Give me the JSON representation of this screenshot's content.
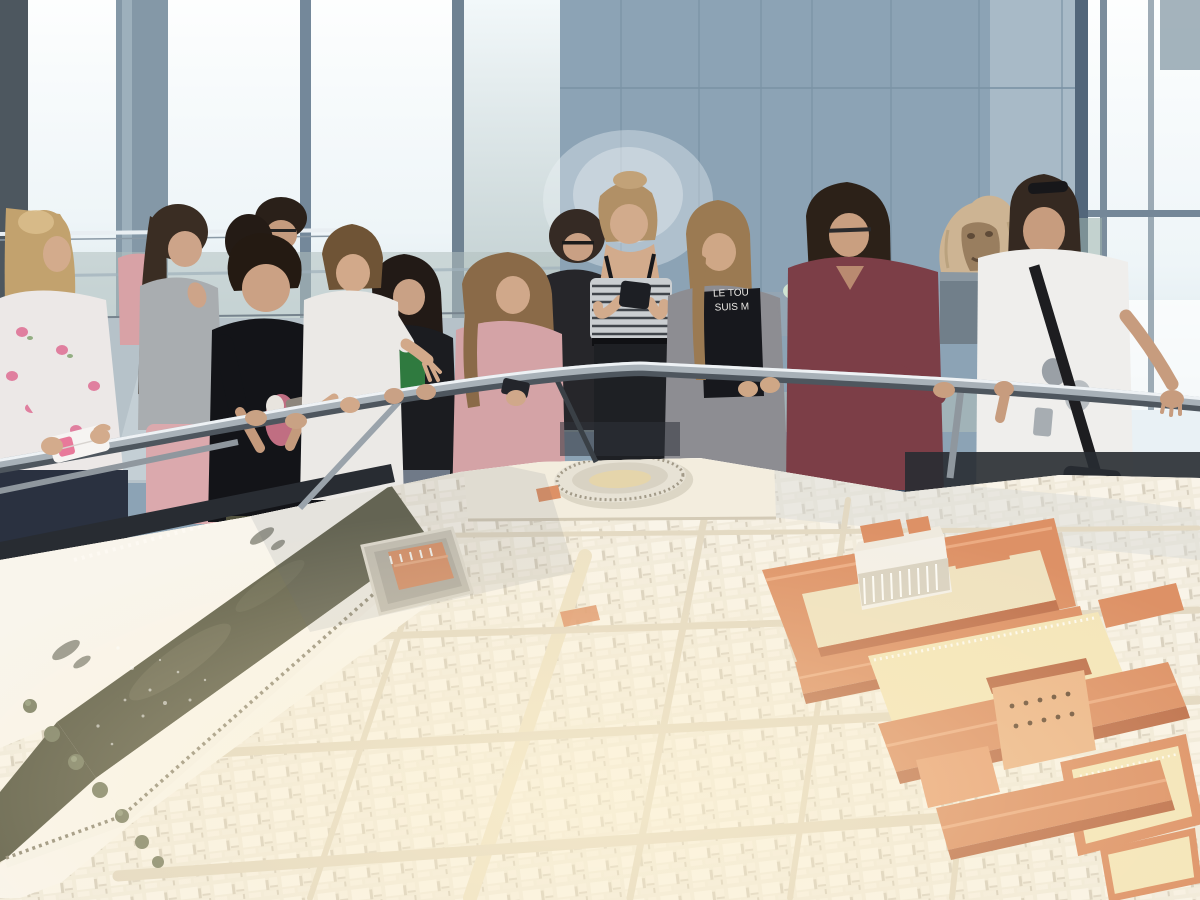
{
  "scene": {
    "setting": "museum gallery with tall daylight windows",
    "subject": "school group standing at a railing viewing a scale model of an ancient Roman city"
  },
  "texts": {
    "tshirt_line1": "LE TOU",
    "tshirt_line2": "SUIS M"
  },
  "env": {
    "wall": "#8ca3b5",
    "wall_light": "#a6b9c6",
    "wall_seam": "#7b93a5",
    "window_bright": "#f5fafc",
    "window_mid": "#dce8ed",
    "window_low": "#b0c0bd",
    "mullion": "#8498a7",
    "mullion_dark": "#5d7181",
    "frame_dark": "#4d575f",
    "floor": "#b6c2c9",
    "floor_bright": "#e9f1f5",
    "counter": "#9aa8b0",
    "mint_object": "#cfe3d2",
    "shadow_band": "#282c32"
  },
  "railing": {
    "tube_dark": "#4e565e",
    "tube_mid": "#a8b1b8",
    "tube_light": "#eef2f5"
  },
  "sculpture": {
    "stone": "#cdb493",
    "stone_shadow": "#8f7456",
    "pedestal": "#717f8a"
  },
  "model": {
    "base": "#efe8d8",
    "block_light": "#f8f3e8",
    "block_shadow": "#d8d0bf",
    "street": "#e3d9c3",
    "street_main": "#ede2c6",
    "plateau": "#f3edde",
    "arena_ring": "#d8d2c3",
    "arena_sand": "#e5d5ab",
    "roof": "#dd9166",
    "roof_light": "#ecab82",
    "roof_dark": "#bd6f4b",
    "courtyard": "#efe2c0",
    "plaza": "#f4e6ba",
    "temple_white": "#f4f0e8",
    "colonnade": "#d9d2c2",
    "hall_wall": "#ecb689",
    "river": "#66654f",
    "river_sheen": "#7b7a62",
    "bank": "#f9f5ec",
    "wall_white": "#f6f2e8",
    "crenel": "#9a937f",
    "tree": "#84876c",
    "boat": "#9b9a8e",
    "cool_blocks": "#d7dad6"
  },
  "people": [
    {
      "label": "girl with long blonde hair checking phone, white floral top",
      "hair": "#c2a26e",
      "top": "#ece8e7",
      "accent": "#e07f9f",
      "bottom": "#2a3140",
      "skin": "#d3ab8c"
    },
    {
      "label": "girl with dark ponytail, grey t-shirt, pink skirt",
      "hair": "#3a2d23",
      "top": "#a9adb0",
      "accent": "#dba9ad",
      "bottom": "#dba9ad",
      "skin": "#cda489"
    },
    {
      "label": "boy with short dark hair, black graphic t-shirt",
      "hair": "#241a12",
      "top": "#131418",
      "accent": "#d4788e",
      "bottom": "#52523e",
      "skin": "#cba184"
    },
    {
      "label": "girl in white t-shirt pointing at the model",
      "hair": "#6f5436",
      "top": "#ebe9e6",
      "accent": "#9aa0a6",
      "bottom": "#ebe9e6",
      "skin": "#d2a98a"
    },
    {
      "label": "girl with long dark hair, black jacket, green t-shirt",
      "hair": "#221a16",
      "top": "#1b1c20",
      "accent": "#2f7a3f",
      "bottom": "#707a88",
      "skin": "#c9a185"
    },
    {
      "label": "girl with wavy brown hair, pink sweater",
      "hair": "#8a6a48",
      "top": "#d4a3a6",
      "accent": "#23252b",
      "bottom": "#868c94",
      "skin": "#d0a88a"
    },
    {
      "label": "teacher with glasses and dark bob, black top",
      "hair": "#352a24",
      "top": "#26262a",
      "accent": "#1b1b1b",
      "bottom": "#26262a",
      "skin": "#c9a084"
    },
    {
      "label": "girl in striped off-shoulder top reading phone",
      "hair": "#b19066",
      "top": "#caced1",
      "accent": "#40454b",
      "bottom": "#1e2024",
      "skin": "#d2ab8c"
    },
    {
      "label": "girl in grey cardigan over black printed t-shirt",
      "hair": "#9b7a52",
      "top": "#8d8d92",
      "accent": "#17181d",
      "bottom": "#5e6a7a",
      "skin": "#cfa786"
    },
    {
      "label": "woman with glasses, burgundy sweater",
      "hair": "#2c2118",
      "top": "#7c3e47",
      "accent": "#b98a70",
      "bottom": "#3f4d63",
      "skin": "#c99f80"
    },
    {
      "label": "woman with sunglasses on head, white theatre-masks t-shirt",
      "hair": "#352921",
      "top": "#efeeec",
      "accent": "#1d1d20",
      "bottom": "#15161a",
      "skin": "#c79c7e"
    },
    {
      "label": "girl with dark hair in background",
      "hair": "#241b15",
      "top": "#2a2a2e",
      "accent": "#2a2a2e",
      "bottom": "#2a2a2e",
      "skin": "#c8a084"
    },
    {
      "label": "boy with glasses in background",
      "hair": "#2a2019",
      "top": "#33343a",
      "accent": "#222222",
      "bottom": "#33343a",
      "skin": "#c49b7e"
    },
    {
      "label": "girl in pink top partially hidden",
      "hair": "#3a2d23",
      "top": "#d8a2a6",
      "accent": "#d8a2a6",
      "bottom": "#d8a2a6",
      "skin": "#cda489"
    }
  ]
}
